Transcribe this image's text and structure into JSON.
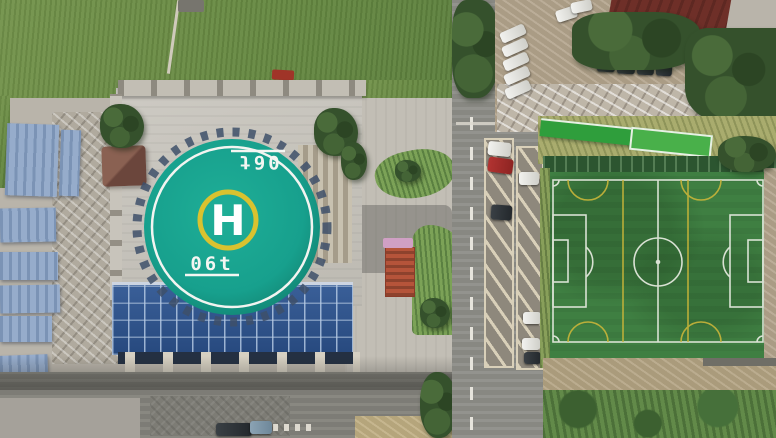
{
  "scene": {
    "title": "Aerial drone view of a rooftop helipad next to a soccer field",
    "helipad": {
      "letter": "H",
      "weight_marking": "06t",
      "surface_color": "#17a08d",
      "ring_color": "#f2f4f0",
      "inner_ring_color": "#d9c22f",
      "letter_color": "#ffffff"
    },
    "soccer_field": {
      "turf_color": "#3f7f42",
      "line_color": "#e2e8dc",
      "secondary_line_color": "#c9b53a",
      "fence_color": "#2c5530",
      "stand_roof_color": "#2f9e3c"
    },
    "buildings": {
      "glass_atrium_color": "#2e5d94",
      "warehouse_roof_color": "#8aa0bf",
      "maroon_roof_color": "#6e2f28",
      "pavilion_roof_color": "#7a5244",
      "red_tower_color": "#b5543a"
    },
    "road": {
      "asphalt_color": "#8f8f89",
      "marking_color": "#e6e4dc",
      "parking_hatch_color": "#d9d0b9"
    },
    "cars": {
      "white": "#f2f2ef",
      "red": "#b23331",
      "dark": "#2c3033",
      "blue_gray": "#8ba3b4"
    }
  }
}
